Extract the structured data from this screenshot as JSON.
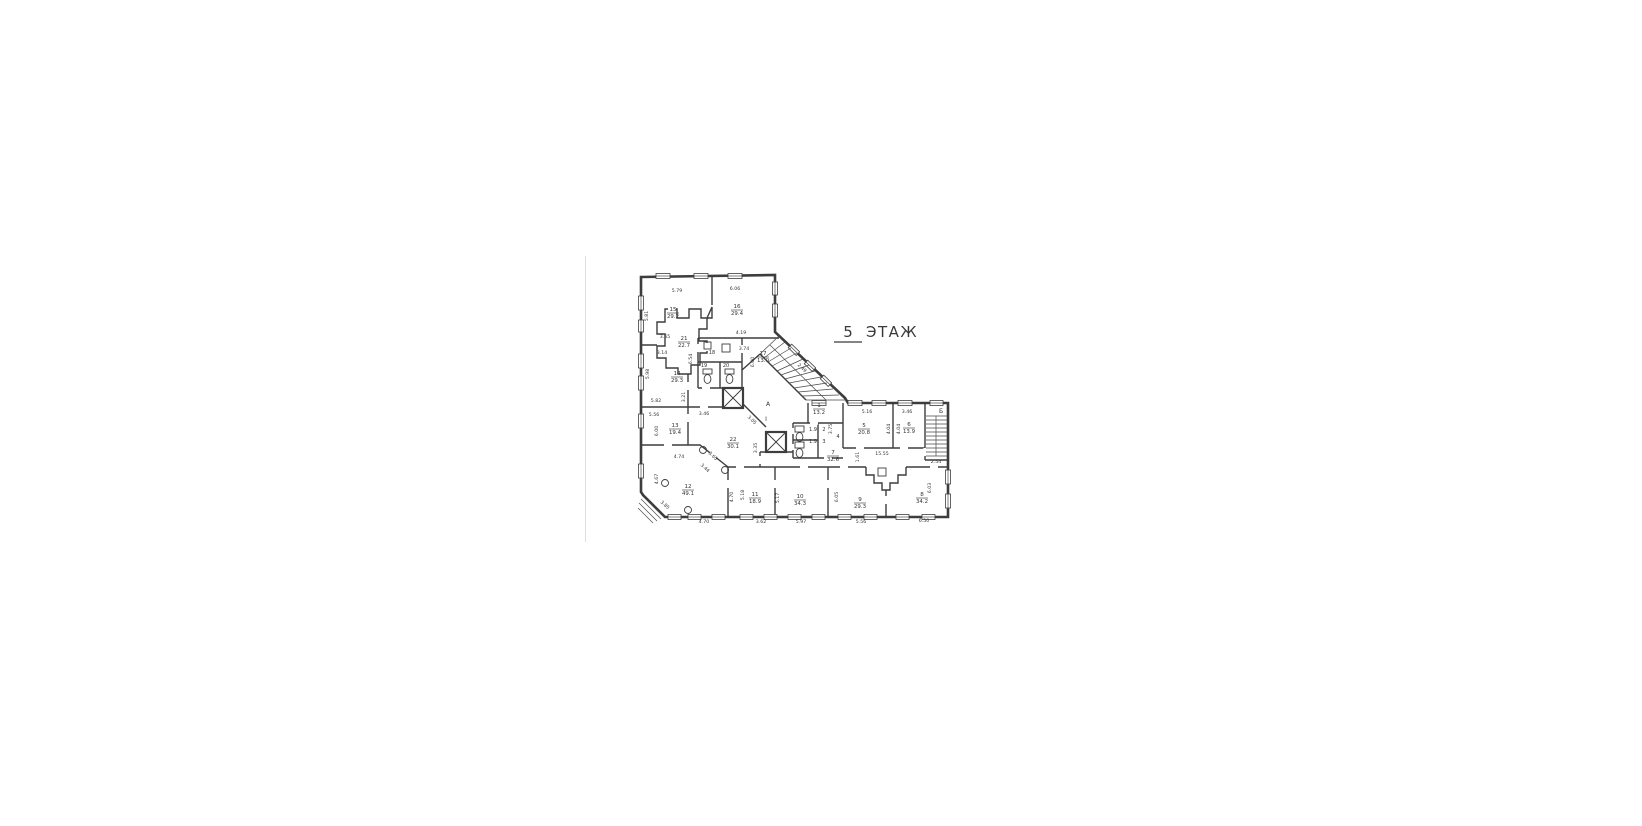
{
  "title": {
    "number": "5",
    "word": "ЭТАЖ"
  },
  "stairs": {
    "a": "А",
    "i": "І",
    "b": "Б"
  },
  "rooms": {
    "r1": {
      "n": "1",
      "a": "13.2"
    },
    "r2": {
      "n": "2",
      "a": "1.9"
    },
    "r3": {
      "n": "3",
      "a": "1.9"
    },
    "r4": {
      "n": "4"
    },
    "r5": {
      "n": "5",
      "a": "20.8"
    },
    "r6": {
      "n": "6",
      "a": "13.9"
    },
    "r7": {
      "n": "7",
      "a": "32.6"
    },
    "r8": {
      "n": "8",
      "a": "34.2"
    },
    "r9": {
      "n": "9",
      "a": "29.3"
    },
    "r10": {
      "n": "10",
      "a": "34.3"
    },
    "r11": {
      "n": "11",
      "a": "18.9"
    },
    "r12": {
      "n": "12",
      "a": "49.1"
    },
    "r13": {
      "n": "13",
      "a": "19.4"
    },
    "r14": {
      "n": "14",
      "a": "29.3"
    },
    "r15": {
      "n": "15",
      "a": "29.2"
    },
    "r16": {
      "n": "16",
      "a": "29.4"
    },
    "r17": {
      "n": "17",
      "a": "13.0"
    },
    "r18": {
      "n": "18"
    },
    "r19": {
      "n": "19"
    },
    "r20": {
      "n": "20"
    },
    "r21": {
      "n": "21",
      "a": "22.7"
    },
    "r22": {
      "n": "22",
      "a": "30.1"
    }
  },
  "dims": [
    "5.79",
    "6.06",
    "5.81",
    "3.65",
    "3.14",
    "4.19",
    "3.74",
    "5.98",
    "6.54",
    "6.00",
    "5.82",
    "3.21",
    "5.56",
    "3.46",
    "6.00",
    "4.74",
    "3.65",
    "3.44",
    "4.67",
    "3.85",
    "4.70",
    "3.62",
    "5.97",
    "5.56",
    "6.50",
    "4.70",
    "5.18",
    "5.17",
    "6.05",
    "6.03",
    "3.05",
    "3.35",
    "2.49",
    "1.61",
    "15.55",
    "2.54",
    "5.16",
    "3.46",
    "4.04",
    "4.04",
    "3.75"
  ],
  "colors": {
    "ink": "#3d3d3d",
    "paper": "#ffffff"
  }
}
